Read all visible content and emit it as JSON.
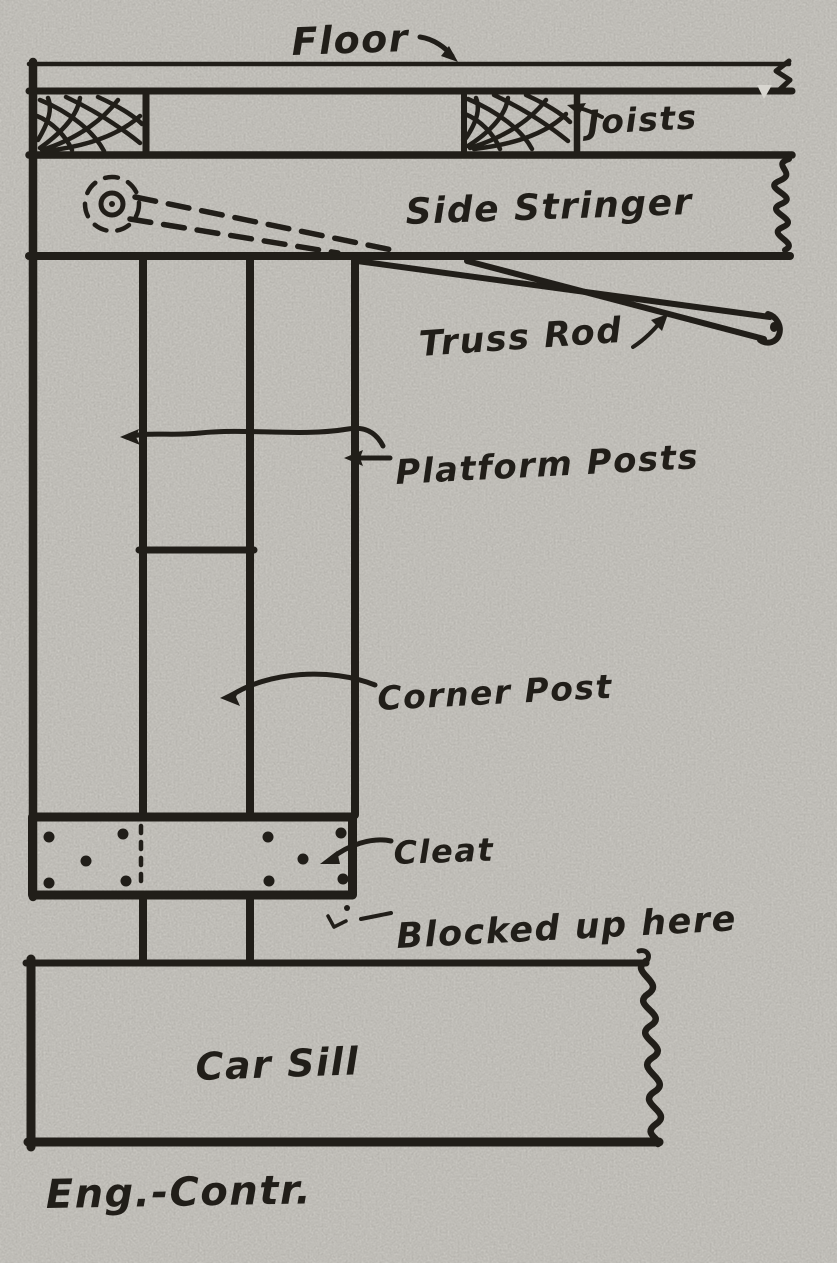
{
  "colors": {
    "paper": "#d8d6d0",
    "ink": "#211e19"
  },
  "labels": {
    "floor": "Floor",
    "joists": "Joists",
    "side_stringer": "Side Stringer",
    "truss_rod": "Truss Rod",
    "platform_posts": "Platform Posts",
    "corner_post": "Corner Post",
    "cleat": "Cleat",
    "blocked_up": "Blocked up here",
    "car_sill": "Car Sill",
    "signature": "Eng.-Contr."
  }
}
